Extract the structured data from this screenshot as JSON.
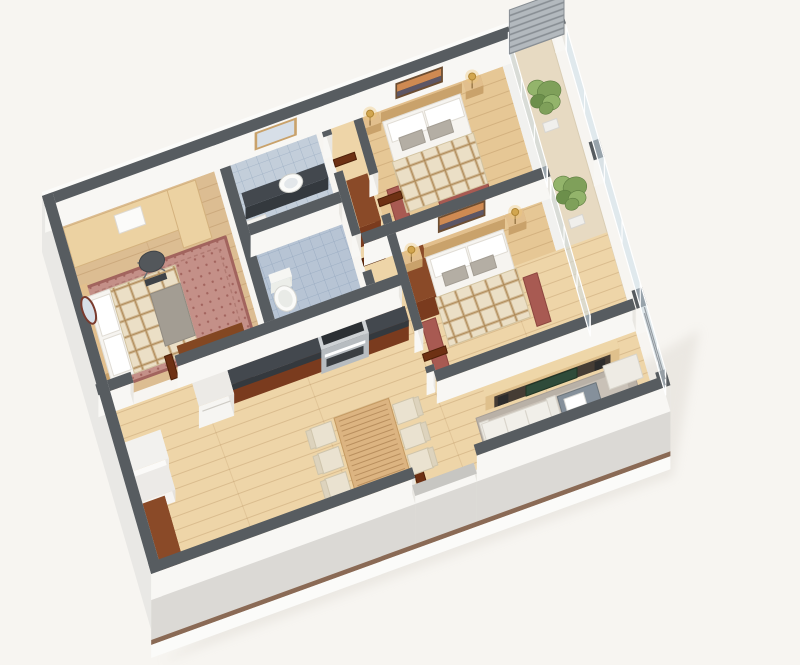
{
  "image": {
    "kind": "3d-isometric-floorplan-render",
    "background": "#f7f5f1"
  },
  "palette": {
    "bg": "#f7f5f1",
    "wall_top": "#575c60",
    "wall_top_low": "#c7c6c2",
    "wall_face_se": "#f8f7f4",
    "wall_face_e": "#e9e7e2",
    "ext_face_sw": "#e9e8e5",
    "ext_face_se": "#dbd9d5",
    "slab_line": "#8a6a55",
    "slab_lip": "#fbfbf9",
    "wood_hall": "#eed5a8",
    "wood_bedroom": "#e6c795",
    "wood_master": "#dcbd92",
    "wood_balcony": "#e7dac2",
    "plank_line": "rgba(146,100,52,0.22)",
    "tile_a": "#c3ceda",
    "tile_b": "#b7c4d4",
    "tile_line": "#9dafc4",
    "counter_dark": "#43484e",
    "counter_side": "#34393e",
    "cabinet_brown": "#8a4a28",
    "cabinet_brown_face": "#7a3b1e",
    "door_brown": "#6e3114",
    "door_brown_edge": "#4e2008",
    "dresser_brown": "#6e3a1e",
    "wood_furniture": "#c9a26b",
    "wood_furniture_top": "#e2bf8d",
    "desk_wood": "#ecd2a2",
    "desk_wood_edge": "#d4b27e",
    "tv_unit_top": "#eed6a8",
    "tv_unit_face": "#dfc08c",
    "tv_shelf": "#453c34",
    "tv_screen": "#2f4b3a",
    "speaker_dark": "#2c2c2c",
    "mattress_white": "#f6f4f0",
    "mattress_edge": "#e2ded6",
    "pillow_gray": "#b4aea4",
    "throw_gray": "#a39d93",
    "plaid_base": "#ebdfc6",
    "plaid_line": "#cbb28a",
    "rug_master": "#c49088",
    "rug_master_edge": "#a2645e",
    "rug_red": "#a85a52",
    "rug_red_edge": "#8d463f",
    "rug_gray": "#b9b1a7",
    "rug_gray_inner": "#c9c1b7",
    "sofa_white": "#f1efe9",
    "sofa_shadow": "#e7e3da",
    "sofa_edge": "#d9d5cc",
    "bench_white": "#eeebe4",
    "table_gray": "#85909b",
    "table_gray_edge": "#6e777d",
    "tray_white": "#ffffff",
    "dining_wood": "#dcb481",
    "dining_slat": "#b98f5e",
    "chair_cream": "#eae2d0",
    "chair_edge": "#cfc5ac",
    "stove_silver": "#ced2d5",
    "stove_face": "#b7bcc0",
    "cooktop_dark": "#2c3034",
    "appliance_dark": "#2e3236",
    "microwave_silver": "#c6cbd0",
    "fridge_white": "#f6f5f2",
    "lamp_gold": "#d2a64f",
    "lamp_glow": "rgba(240,200,120,0.38)",
    "glass": "rgba(206,222,233,0.55)",
    "frame_white": "#ffffff",
    "railing_gray": "#959ca2",
    "lattice_base": "#b3b9be",
    "lattice_line": "#878d93",
    "art_frame": "#6d4e32",
    "art_sky": "#cf8a52",
    "art_ground": "#5c5666",
    "mirror_glass": "#d7dfe8",
    "mirror_oval_frame": "#7a3b2e",
    "plant_g1": "#7fa05a",
    "plant_g2": "#93b46b",
    "plant_g3": "#6c8f4b",
    "chair_office": "#53575b",
    "toilet_white": "#fafaf8",
    "shadow": "#cdc7bd"
  },
  "apartment": {
    "view": "isometric-cutaway",
    "rooms": [
      {
        "name": "master-bedroom",
        "furniture": [
          "desk",
          "office-chair",
          "double-bed",
          "plaid-blanket",
          "pillows",
          "area-rug",
          "dresser",
          "oval-wall-mirror"
        ]
      },
      {
        "name": "bathroom-1",
        "furniture": [
          "vanity-counter",
          "sink",
          "wall-mirror",
          "cabinet"
        ]
      },
      {
        "name": "bathroom-2",
        "furniture": [
          "toilet",
          "tiled-floor"
        ]
      },
      {
        "name": "hallway",
        "furniture": [
          "wardrobe",
          "interior-doors"
        ]
      },
      {
        "name": "bedroom-1",
        "furniture": [
          "double-bed",
          "pillows",
          "plaid-blanket",
          "nightstands",
          "table-lamps",
          "wall-art",
          "red-rugs"
        ]
      },
      {
        "name": "bedroom-2",
        "furniture": [
          "double-bed",
          "pillows",
          "plaid-blanket",
          "nightstands",
          "table-lamps",
          "wall-art",
          "wardrobe",
          "runner-rugs"
        ]
      },
      {
        "name": "kitchen",
        "furniture": [
          "upper-cabinets",
          "countertop",
          "oven-stove",
          "microwave",
          "refrigerator",
          "washer-cabinets"
        ]
      },
      {
        "name": "dining-area",
        "furniture": [
          "slatted-dining-table",
          "six-chairs"
        ]
      },
      {
        "name": "living-room",
        "furniture": [
          "tv-wall-unit",
          "television",
          "speakers",
          "sofa",
          "coffee-table",
          "ottoman-bench",
          "gray-area-rug"
        ]
      },
      {
        "name": "balcony",
        "furniture": [
          "potted-plants",
          "privacy-lattice-screen",
          "glass-doors",
          "railing"
        ]
      },
      {
        "name": "entrance",
        "furniture": [
          "shoe-cabinet",
          "front-door"
        ]
      }
    ]
  }
}
